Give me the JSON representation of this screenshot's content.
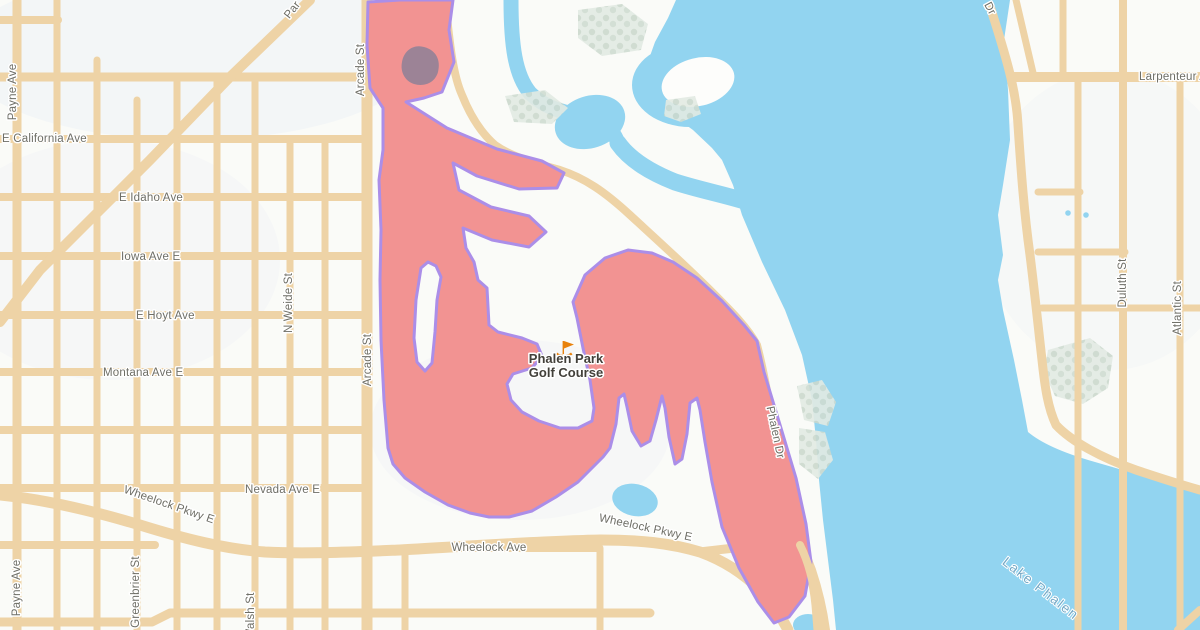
{
  "map": {
    "poi": {
      "line1": "Phalen Park",
      "line2": "Golf Course",
      "icon": "golf-flag-icon"
    },
    "water_labels": {
      "lake": "Lake Phalen"
    },
    "street_labels": {
      "payne_ave": "Payne Ave",
      "e_california": "E California Ave",
      "e_idaho": "E Idaho Ave",
      "iowa": "Iowa Ave E",
      "e_hoyt": "E Hoyt Ave",
      "montana": "Montana Ave E",
      "n_weide": "N Weide St",
      "arcade": "Arcade St",
      "nevada": "Nevada Ave E",
      "wheelock_pkwy": "Wheelock Pkwy E",
      "wheelock_ave": "Wheelock Ave",
      "greenbrier": "Greenbrier St",
      "n_walsh": "N Walsh St",
      "phalen_dr": "Phalen Dr",
      "duluth": "Duluth St",
      "atlantic": "Atlantic St",
      "larpenteur": "Larpenteur Ave",
      "dr_partial": "Dr",
      "par_partial": "Par"
    },
    "colors": {
      "land": "#fafbf8",
      "water": "#92d4f0",
      "road": "#eed3a6",
      "highlight_fill": "#f29392",
      "boundary_stroke": "#ab8ee8",
      "trees": "#e2eae3",
      "building": "#9c8396",
      "street_label": "#6e6e66",
      "water_label": "#74a9c6",
      "poi_label": "#42403a",
      "poi_icon": "#e8820c"
    }
  }
}
